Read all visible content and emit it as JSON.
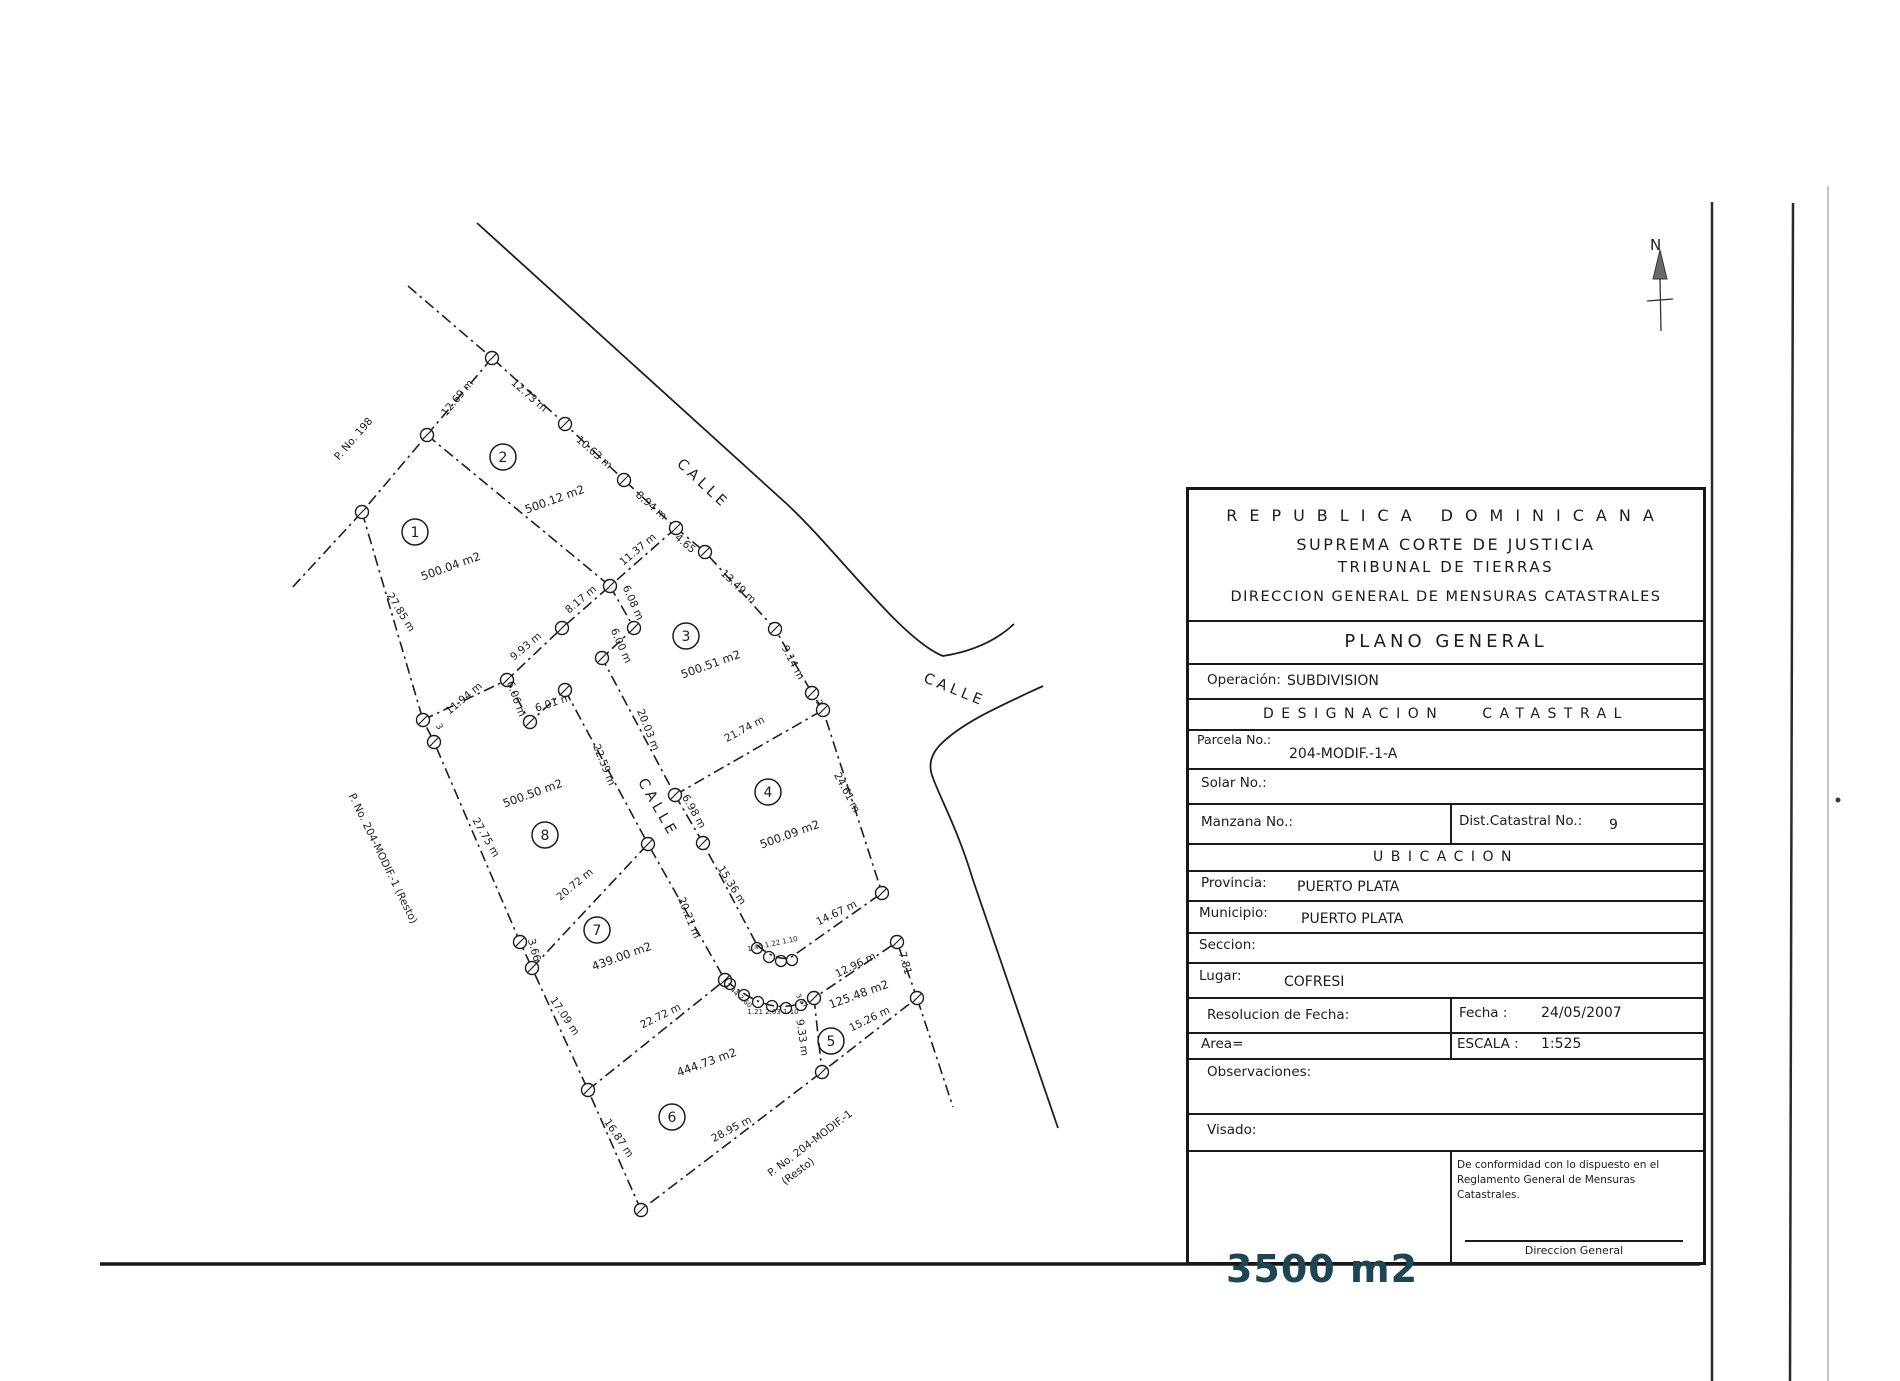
{
  "map": {
    "north_label": "N",
    "street_labels": [
      {
        "text": "CALLE",
        "x": 700,
        "y": 487,
        "r": 43
      },
      {
        "text": "CALLE",
        "x": 953,
        "y": 694,
        "r": 22
      },
      {
        "text": "CALLE",
        "x": 654,
        "y": 810,
        "r": 60
      }
    ],
    "neighbor_labels": [
      {
        "text": "P. No. 198",
        "x": 356,
        "y": 441,
        "r": -49
      },
      {
        "text": "P. No. 204-MODIF.-1 (Resto)",
        "x": 380,
        "y": 860,
        "r": 64
      },
      {
        "text": "P. No. 204-MODIF.-1",
        "x": 812,
        "y": 1146,
        "r": -37
      },
      {
        "text": "(Resto)",
        "x": 800,
        "y": 1174,
        "r": -37
      }
    ],
    "parcels": [
      {
        "num": "1",
        "cx": 415,
        "cy": 532,
        "area": "500.04 m2",
        "ax": 452,
        "ay": 570,
        "ar": -20
      },
      {
        "num": "2",
        "cx": 503,
        "cy": 457,
        "area": "500.12 m2",
        "ax": 556,
        "ay": 503,
        "ar": -20
      },
      {
        "num": "3",
        "cx": 686,
        "cy": 636,
        "area": "500.51 m2",
        "ax": 712,
        "ay": 668,
        "ar": -20
      },
      {
        "num": "4",
        "cx": 768,
        "cy": 792,
        "area": "500.09 m2",
        "ax": 791,
        "ay": 838,
        "ar": -20
      },
      {
        "num": "5",
        "cx": 831,
        "cy": 1041,
        "area": "125.48 m2",
        "ax": 860,
        "ay": 998,
        "ar": -20
      },
      {
        "num": "6",
        "cx": 672,
        "cy": 1117,
        "area": "444.73 m2",
        "ax": 708,
        "ay": 1066,
        "ar": -20
      },
      {
        "num": "7",
        "cx": 597,
        "cy": 930,
        "area": "439.00 m2",
        "ax": 623,
        "ay": 960,
        "ar": -20
      },
      {
        "num": "8",
        "cx": 545,
        "cy": 835,
        "area": "500.50 m2",
        "ax": 534,
        "ay": 797,
        "ar": -20
      }
    ],
    "measurements": [
      {
        "text": "12.69 m",
        "x": 460,
        "y": 400,
        "r": -50
      },
      {
        "text": "12.73 m",
        "x": 527,
        "y": 398,
        "r": 41
      },
      {
        "text": "10.63 m",
        "x": 592,
        "y": 455,
        "r": 41
      },
      {
        "text": "8.94 m",
        "x": 649,
        "y": 508,
        "r": 41
      },
      {
        "text": "4.65",
        "x": 683,
        "y": 546,
        "r": 41
      },
      {
        "text": "13.49 m",
        "x": 736,
        "y": 589,
        "r": 43
      },
      {
        "text": "9.14 m",
        "x": 790,
        "y": 664,
        "r": 62
      },
      {
        "text": "11.37 m",
        "x": 640,
        "y": 552,
        "r": -40
      },
      {
        "text": "8.17 m",
        "x": 583,
        "y": 602,
        "r": -40
      },
      {
        "text": "6.08 m",
        "x": 630,
        "y": 604,
        "r": 66
      },
      {
        "text": "6.00 m",
        "x": 618,
        "y": 647,
        "r": 66
      },
      {
        "text": "9.93 m",
        "x": 528,
        "y": 649,
        "r": -40
      },
      {
        "text": "6.06 m",
        "x": 513,
        "y": 700,
        "r": 70
      },
      {
        "text": "6.01 m",
        "x": 554,
        "y": 706,
        "r": -18
      },
      {
        "text": "11.94 m",
        "x": 466,
        "y": 701,
        "r": -40
      },
      {
        "text": "27.85 m",
        "x": 398,
        "y": 614,
        "r": 58
      },
      {
        "text": "27.75 m",
        "x": 483,
        "y": 839,
        "r": 60
      },
      {
        "text": "22.59 m",
        "x": 601,
        "y": 766,
        "r": 68
      },
      {
        "text": "20.03 m",
        "x": 645,
        "y": 731,
        "r": 68
      },
      {
        "text": "20.72 m",
        "x": 577,
        "y": 887,
        "r": -40
      },
      {
        "text": "20.21 m",
        "x": 686,
        "y": 919,
        "r": 68
      },
      {
        "text": "15.36 m",
        "x": 729,
        "y": 887,
        "r": 58
      },
      {
        "text": "21.74 m",
        "x": 746,
        "y": 732,
        "r": -28
      },
      {
        "text": "24.61 m",
        "x": 844,
        "y": 794,
        "r": 62
      },
      {
        "text": "14.67 m",
        "x": 838,
        "y": 916,
        "r": -26
      },
      {
        "text": "6.98 m",
        "x": 691,
        "y": 813,
        "r": 60
      },
      {
        "text": "12.96 m",
        "x": 857,
        "y": 968,
        "r": -26
      },
      {
        "text": "7.81",
        "x": 902,
        "y": 964,
        "r": 74
      },
      {
        "text": "15.26 m",
        "x": 871,
        "y": 1022,
        "r": -26
      },
      {
        "text": "9.33 m",
        "x": 799,
        "y": 1038,
        "r": 82
      },
      {
        "text": "22.72 m",
        "x": 662,
        "y": 1019,
        "r": -26
      },
      {
        "text": "17.09 m",
        "x": 562,
        "y": 1018,
        "r": 56
      },
      {
        "text": "3.66",
        "x": 531,
        "y": 951,
        "r": 74
      },
      {
        "text": "16.87 m",
        "x": 616,
        "y": 1140,
        "r": 56
      },
      {
        "text": "28.95 m",
        "x": 733,
        "y": 1132,
        "r": -28
      }
    ],
    "tiny_labels": [
      {
        "text": "1.46 1.22 1.10",
        "x": 773,
        "y": 946,
        "r": -12
      },
      {
        "text": "1.44 2.60",
        "x": 737,
        "y": 997,
        "r": 42
      },
      {
        "text": "1.21 2.03 1.10",
        "x": 773,
        "y": 1014,
        "r": 0
      },
      {
        "text": "3.27",
        "x": 800,
        "y": 1002,
        "r": 56
      }
    ],
    "point_labels": [
      {
        "text": "2",
        "x": 817,
        "y": 704,
        "r": 60
      },
      {
        "text": "3",
        "x": 437,
        "y": 728,
        "r": 60
      }
    ]
  },
  "title_block": {
    "header_line1": "REPUBLICA DOMINICANA",
    "header_line2": "SUPREMA CORTE DE JUSTICIA",
    "header_line3": "TRIBUNAL DE TIERRAS",
    "header_line4": "DIRECCION GENERAL DE MENSURAS CATASTRALES",
    "plano": "PLANO GENERAL",
    "operacion_label": "Operación:",
    "operacion_value": "SUBDIVISION",
    "designacion_1": "DESIGNACION",
    "designacion_2": "CATASTRAL",
    "parcela_label": "Parcela No.:",
    "parcela_value": "204-MODIF.-1-A",
    "solar_label": "Solar No.:",
    "manzana_label": "Manzana No.:",
    "dist_label": "Dist.Catastral No.:",
    "dist_value": "9",
    "ubicacion": "UBICACION",
    "provincia_label": "Provincia:",
    "provincia_value": "PUERTO PLATA",
    "municipio_label": "Municipio:",
    "municipio_value": "PUERTO PLATA",
    "seccion_label": "Seccion:",
    "lugar_label": "Lugar:",
    "lugar_value": "COFRESI",
    "resolucion_label": "Resolucion  de Fecha:",
    "fecha_label": "Fecha :",
    "fecha_value": "24/05/2007",
    "area_label": "Area=",
    "escala_label": "ESCALA :",
    "escala_value": "1:525",
    "observaciones_label": "Observaciones:",
    "visado_label": "Visado:",
    "conformidad_line1": "De conformidad con lo dispuesto en el",
    "conformidad_line2": "Reglamento General de Mensuras Catastrales.",
    "direccion_general": "Direccion General"
  },
  "stamp": {
    "text": "3500 m2",
    "color": "#1d4553"
  }
}
